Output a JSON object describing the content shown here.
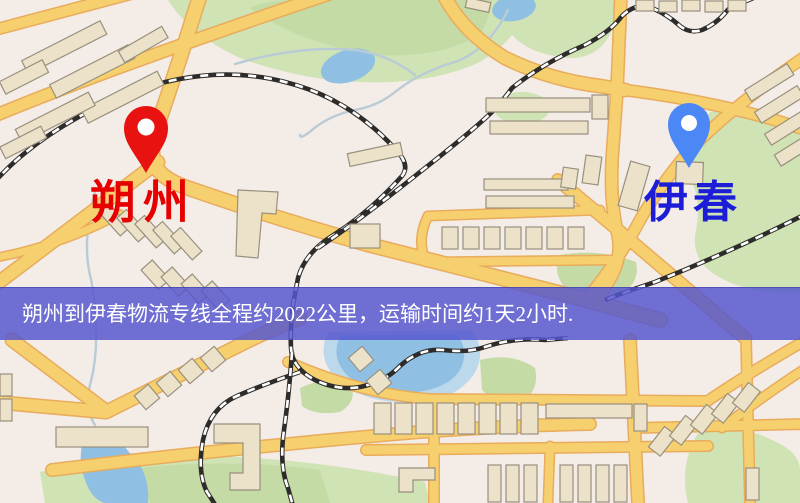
{
  "page": {
    "type": "logistics-route-map-image"
  },
  "origin_marker": {
    "label": "朔州",
    "pin_color": "#e81210",
    "label_color": "#e60000"
  },
  "destination_marker": {
    "label": "伊春",
    "pin_color": "#4b87f5",
    "label_color": "#1d1dd8"
  },
  "banner": {
    "text": "朔州到伊春物流专线全程约2022公里，运输时间约1天2小时.",
    "bg_color": "rgba(86,86,206,0.84)",
    "text_color": "#ffffff"
  },
  "map_palette": {
    "background": "#f3ece7",
    "road": "#f6d06e",
    "road_casing": "#e9ab5c",
    "building": "#ebe2c9",
    "building_outline": "#99907e",
    "park": "#cfe3b4",
    "water": "#8fc0e4",
    "railway": "#2e2c2a"
  }
}
